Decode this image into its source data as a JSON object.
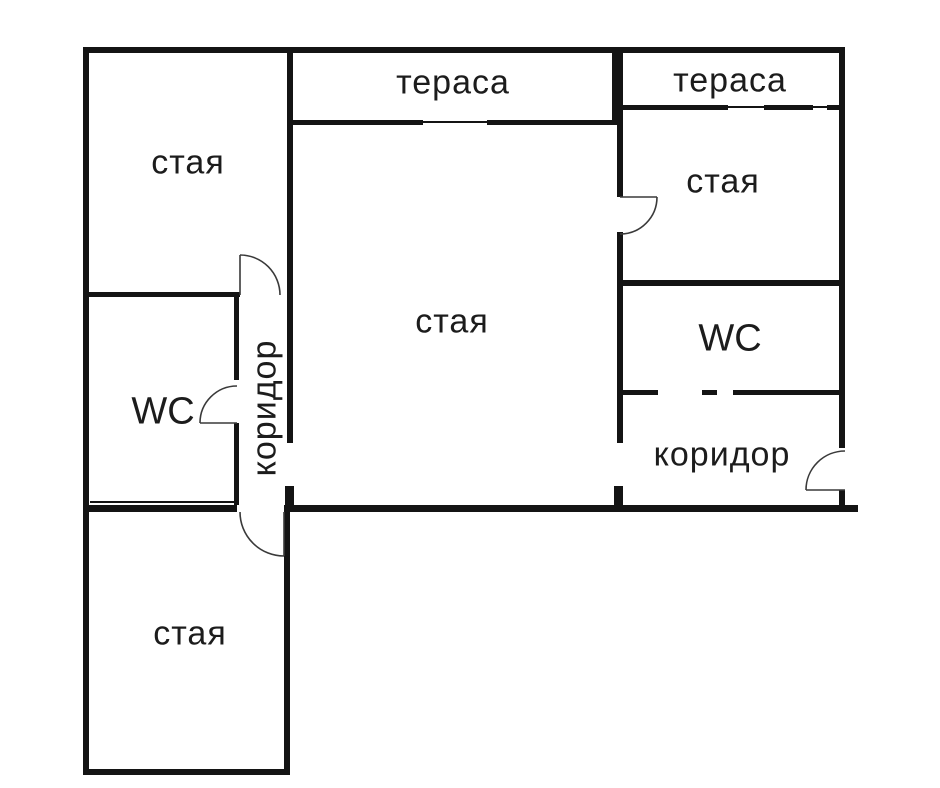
{
  "plan": {
    "type": "apartment-floor-plan",
    "language": "bg",
    "colors": {
      "wall": "#141414",
      "door_line": "#3a3a3a",
      "background": "#ffffff"
    },
    "rooms": {
      "room_top_left": {
        "label": "стая"
      },
      "terrace_middle": {
        "label": "тераса"
      },
      "terrace_right": {
        "label": "тераса"
      },
      "room_right": {
        "label": "стая"
      },
      "room_main": {
        "label": "стая"
      },
      "wc_right": {
        "label": "WC"
      },
      "wc_left": {
        "label": "WC"
      },
      "corridor_left": {
        "label": "коридор"
      },
      "corridor_right": {
        "label": "коридор"
      },
      "room_bottom": {
        "label": "стая"
      }
    }
  }
}
